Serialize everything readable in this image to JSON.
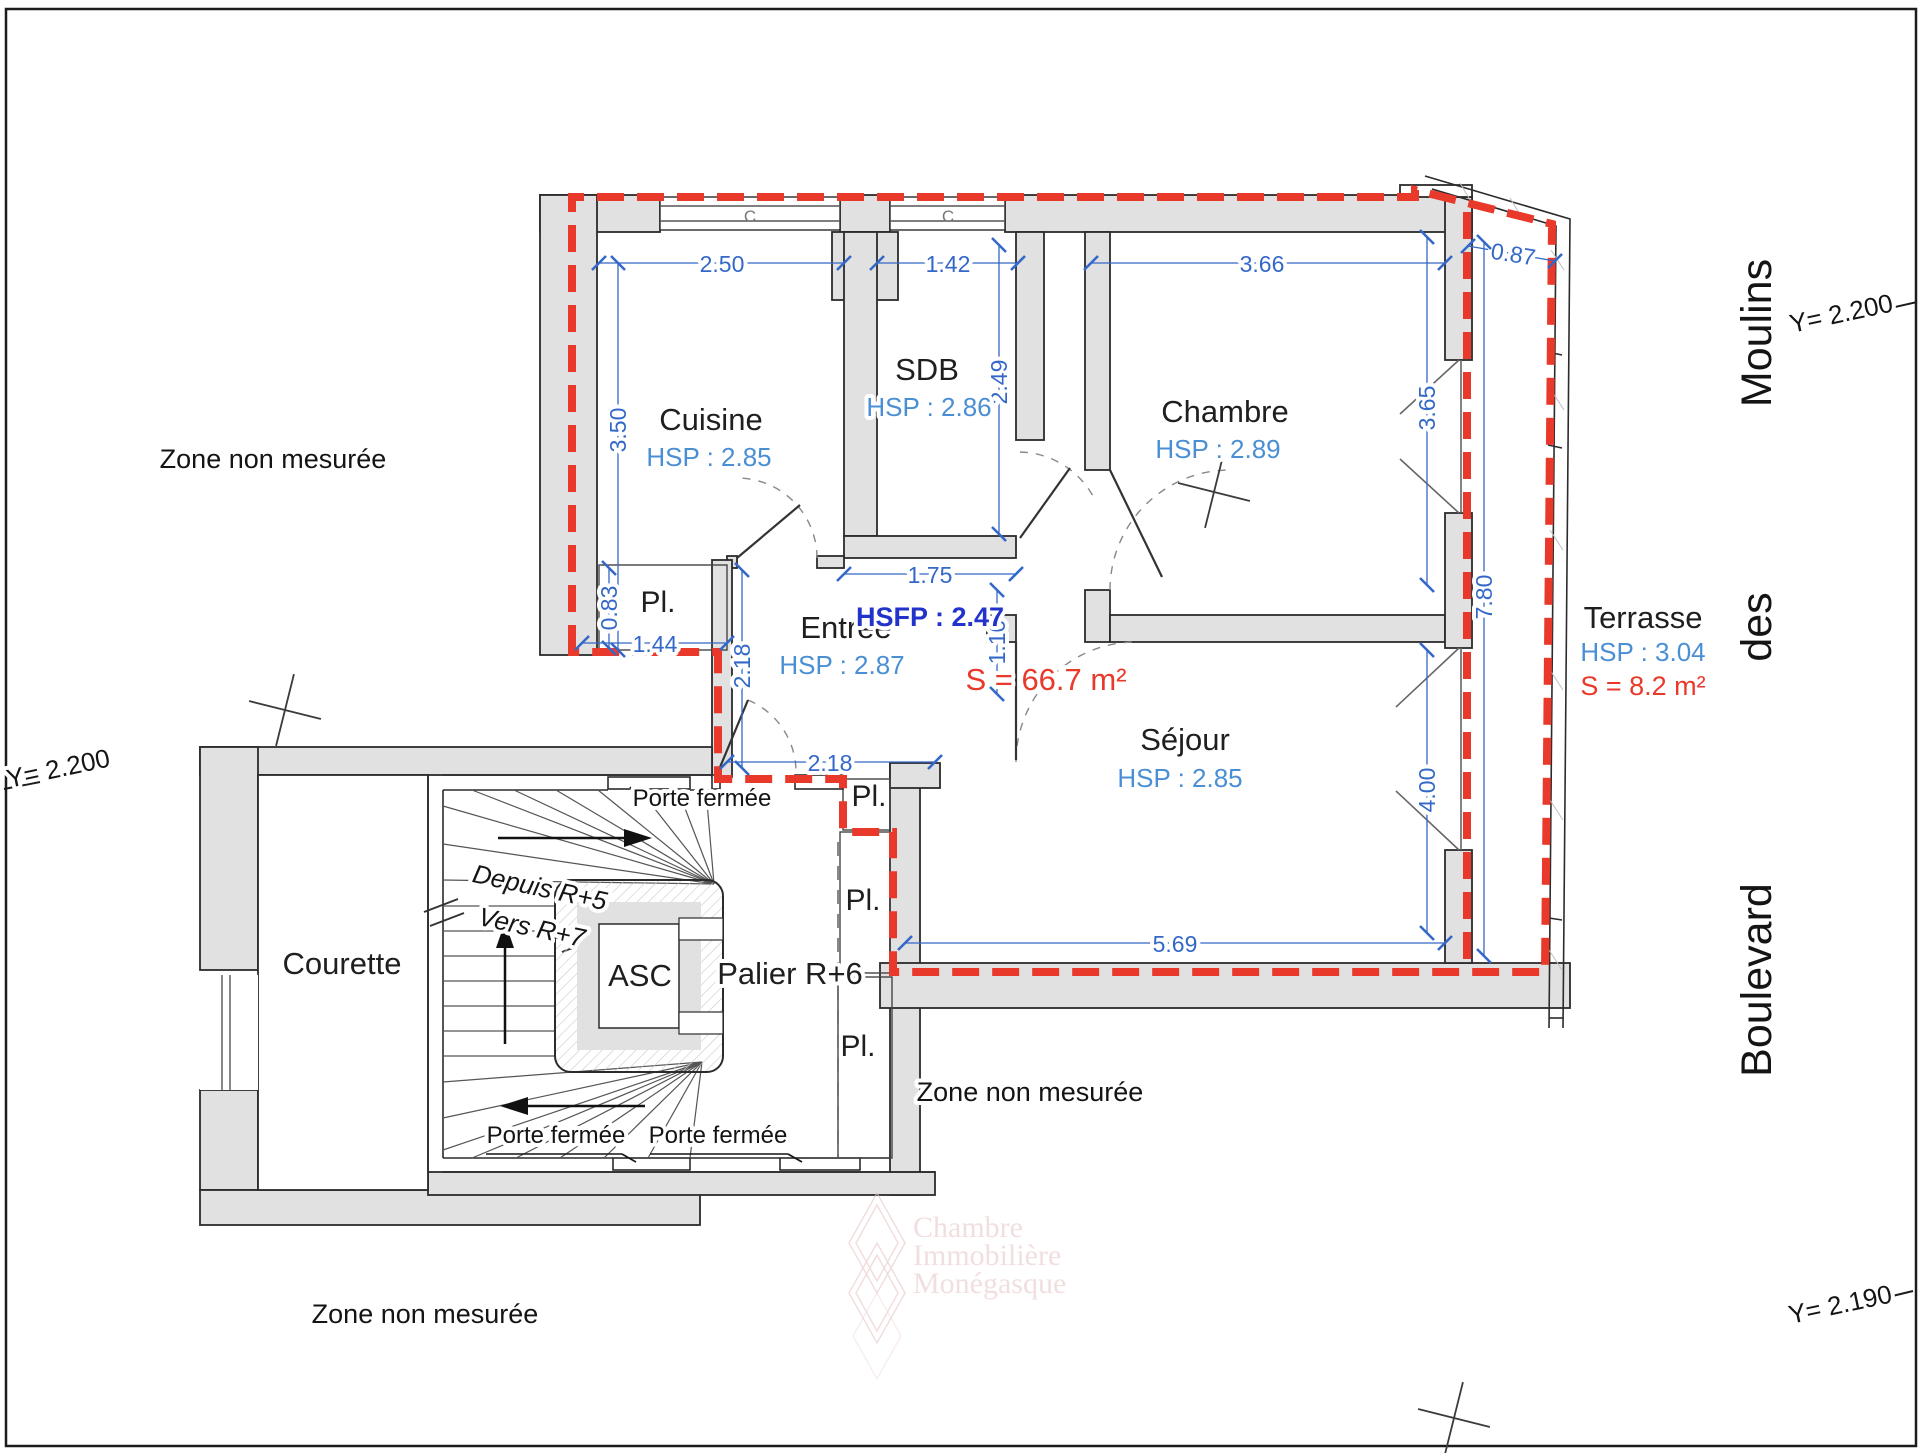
{
  "colors": {
    "boundary_red": "#e8392b",
    "dimension_blue": "#3468c8",
    "hsp_blue": "#4a8fd4",
    "hsfp_blue": "#2233cc",
    "wall_gray": "#e1e1e1",
    "line_dark": "#2b2b2b",
    "watermark_pink": "#e7c6c6"
  },
  "plan": {
    "rooms": [
      {
        "name": "Cuisine",
        "hsp": "HSP : 2.85",
        "nx": 711,
        "ny": 430,
        "hx": 709,
        "hy": 466
      },
      {
        "name": "SDB",
        "hsp": "HSP : 2.86",
        "nx": 927,
        "ny": 380,
        "hx": 929,
        "hy": 416
      },
      {
        "name": "Chambre",
        "hsp": "HSP : 2.89",
        "nx": 1225,
        "ny": 422,
        "hx": 1218,
        "hy": 458
      },
      {
        "name": "Entrée",
        "hsp": "HSP : 2.87",
        "nx": 846,
        "ny": 638,
        "hx": 842,
        "hy": 674
      },
      {
        "name": "Séjour",
        "hsp": "HSP : 2.85",
        "nx": 1185,
        "ny": 750,
        "hx": 1180,
        "hy": 787
      },
      {
        "name": "Terrasse",
        "hsp": "HSP : 3.04",
        "nx": 1643,
        "ny": 628,
        "hx": 1643,
        "hy": 661
      },
      {
        "name": "Courette",
        "hsp": null,
        "nx": 342,
        "ny": 974,
        "hx": 0,
        "hy": 0
      },
      {
        "name": "ASC",
        "hsp": null,
        "nx": 640,
        "ny": 986,
        "hx": 0,
        "hy": 0
      },
      {
        "name": "Palier R+6",
        "hsp": null,
        "nx": 790,
        "ny": 984,
        "hx": 0,
        "hy": 0
      }
    ],
    "closet_label": "Pl.",
    "closet_positions": [
      [
        658,
        612
      ],
      [
        869,
        806
      ],
      [
        863,
        910
      ],
      [
        858,
        1056
      ]
    ],
    "hsfp": {
      "text": "HSFP : 2.47",
      "x": 930,
      "y": 626
    },
    "apartment_area": {
      "text": "S = 66.7 m²",
      "x": 1046,
      "y": 690
    },
    "terrace_area": {
      "text": "S = 8.2 m²",
      "x": 1643,
      "y": 695
    },
    "dimensions": [
      {
        "label": "2.50",
        "x1": 599,
        "y1": 263,
        "x2": 844,
        "y2": 263,
        "lx": 722,
        "ly": 272,
        "rot": 0
      },
      {
        "label": "1.42",
        "x1": 877,
        "y1": 263,
        "x2": 1018,
        "y2": 263,
        "lx": 948,
        "ly": 272,
        "rot": 0
      },
      {
        "label": "3.66",
        "x1": 1091,
        "y1": 263,
        "x2": 1445,
        "y2": 263,
        "lx": 1262,
        "ly": 272,
        "rot": 0
      },
      {
        "label": "0.87",
        "x1": 1468,
        "y1": 246,
        "x2": 1555,
        "y2": 261,
        "lx": 1512,
        "ly": 262,
        "rot": 9
      },
      {
        "label": "3.50",
        "x1": 618,
        "y1": 263,
        "x2": 618,
        "y2": 650,
        "lx": 626,
        "ly": 430,
        "rot": -90
      },
      {
        "label": "2.49",
        "x1": 999,
        "y1": 245,
        "x2": 999,
        "y2": 534,
        "lx": 1007,
        "ly": 382,
        "rot": -90
      },
      {
        "label": "1.75",
        "x1": 844,
        "y1": 574,
        "x2": 1016,
        "y2": 574,
        "lx": 930,
        "ly": 583,
        "rot": 0
      },
      {
        "label": "1.10",
        "x1": 997,
        "y1": 590,
        "x2": 997,
        "y2": 694,
        "lx": 1005,
        "ly": 642,
        "rot": -90
      },
      {
        "label": "0.83",
        "x1": 609,
        "y1": 568,
        "x2": 609,
        "y2": 648,
        "lx": 617,
        "ly": 608,
        "rot": -90
      },
      {
        "label": "1.44",
        "x1": 582,
        "y1": 643,
        "x2": 727,
        "y2": 643,
        "lx": 655,
        "ly": 652,
        "rot": 0
      },
      {
        "label": "2.18",
        "x1": 742,
        "y1": 570,
        "x2": 742,
        "y2": 768,
        "lx": 750,
        "ly": 666,
        "rot": -90
      },
      {
        "label": "2.18",
        "x1": 727,
        "y1": 762,
        "x2": 935,
        "y2": 762,
        "lx": 830,
        "ly": 771,
        "rot": 0
      },
      {
        "label": "5.69",
        "x1": 905,
        "y1": 943,
        "x2": 1445,
        "y2": 943,
        "lx": 1175,
        "ly": 952,
        "rot": 0
      },
      {
        "label": "3.65",
        "x1": 1427,
        "y1": 237,
        "x2": 1427,
        "y2": 585,
        "lx": 1435,
        "ly": 408,
        "rot": -90
      },
      {
        "label": "4.00",
        "x1": 1427,
        "y1": 650,
        "x2": 1427,
        "y2": 933,
        "lx": 1435,
        "ly": 790,
        "rot": -90
      },
      {
        "label": "7.80",
        "x1": 1484,
        "y1": 242,
        "x2": 1484,
        "y2": 956,
        "lx": 1492,
        "ly": 597,
        "rot": -90
      }
    ],
    "zones": {
      "text": "Zone non mesurée",
      "positions": [
        [
          273,
          468
        ],
        [
          1030,
          1101
        ],
        [
          425,
          1323
        ]
      ]
    },
    "street": {
      "name": "Boulevard des Moulins",
      "words": [
        {
          "text": "Moulins",
          "x": 1771,
          "y": 333
        },
        {
          "text": "des",
          "x": 1771,
          "y": 627
        },
        {
          "text": "Boulevard",
          "x": 1771,
          "y": 980
        }
      ]
    },
    "survey_markers": [
      {
        "label": "Y= 2.200",
        "x": 1843,
        "y": 322,
        "rot": -12
      },
      {
        "label": "Y= 2.200",
        "x": 60,
        "y": 777,
        "rot": -12
      },
      {
        "label": "Y= 2.190",
        "x": 1842,
        "y": 1313,
        "rot": -12
      }
    ],
    "door_labels": [
      {
        "text": "Porte fermée",
        "x": 702,
        "y": 806
      },
      {
        "text": "Porte fermée",
        "x": 556,
        "y": 1143
      },
      {
        "text": "Porte fermée",
        "x": 718,
        "y": 1143
      }
    ],
    "stair_labels": [
      {
        "text": "Depuis R+5",
        "x": 538,
        "y": 896,
        "rot": 12
      },
      {
        "text": "Vers R+7",
        "x": 530,
        "y": 936,
        "rot": 12
      }
    ],
    "watermark": {
      "lines": [
        "Chambre",
        "Immobilière",
        "Monégasque"
      ],
      "x": 913,
      "ys": [
        1237,
        1265,
        1293
      ]
    }
  }
}
